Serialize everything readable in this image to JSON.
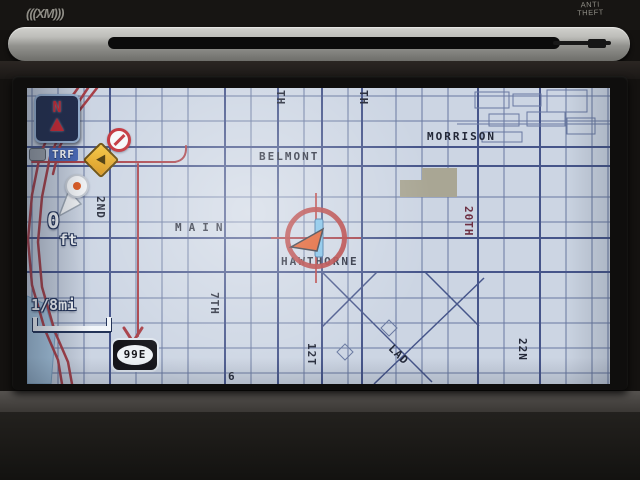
{
  "hardware": {
    "xm_logo": "(((XM)))",
    "anti_theft_line1": "ANTI",
    "anti_theft_line2": "THEFT"
  },
  "screen": {
    "compass_n": "N",
    "traffic_label": "TRF",
    "distance_value": "0",
    "distance_unit": "ft",
    "scale_label": "1/8mi",
    "route_shield_label": "99E",
    "colors": {
      "map_background": "#ccd5e3",
      "road_minor": "#6878a0",
      "road_major": "#46558a",
      "traffic_red": "#a84048",
      "street_label": "#232838",
      "street_label_maroon": "#6d2f42",
      "water": "#a9c8e1",
      "block_tan": "#a9a694",
      "cursor_red": "#b43c3c",
      "incident_yellow": "#e8ab30"
    },
    "street_labels": [
      {
        "text": "MORRISON",
        "x": 400,
        "y": 42,
        "rot": 0
      },
      {
        "text": "BELMONT",
        "x": 232,
        "y": 62,
        "rot": 0
      },
      {
        "text": "MAIN",
        "x": 148,
        "y": 133,
        "rot": 0,
        "spaced": true
      },
      {
        "text": "HAWTHORNE",
        "x": 254,
        "y": 167,
        "rot": 0
      },
      {
        "text": "TH",
        "x": 247,
        "y": 2,
        "rot": 90
      },
      {
        "text": "TH",
        "x": 330,
        "y": 2,
        "rot": 90
      },
      {
        "text": "2ND",
        "x": 67,
        "y": 108,
        "rot": 90
      },
      {
        "text": "7TH",
        "x": 181,
        "y": 204,
        "rot": 90
      },
      {
        "text": "12T",
        "x": 278,
        "y": 255,
        "rot": 90
      },
      {
        "text": "20TH",
        "x": 435,
        "y": 118,
        "rot": 90,
        "color": "maroon"
      },
      {
        "text": "22N",
        "x": 489,
        "y": 250,
        "rot": 90
      },
      {
        "text": "LAD",
        "x": 368,
        "y": 254,
        "rot": 45
      },
      {
        "text": "6",
        "x": 201,
        "y": 282,
        "rot": 0
      }
    ]
  }
}
